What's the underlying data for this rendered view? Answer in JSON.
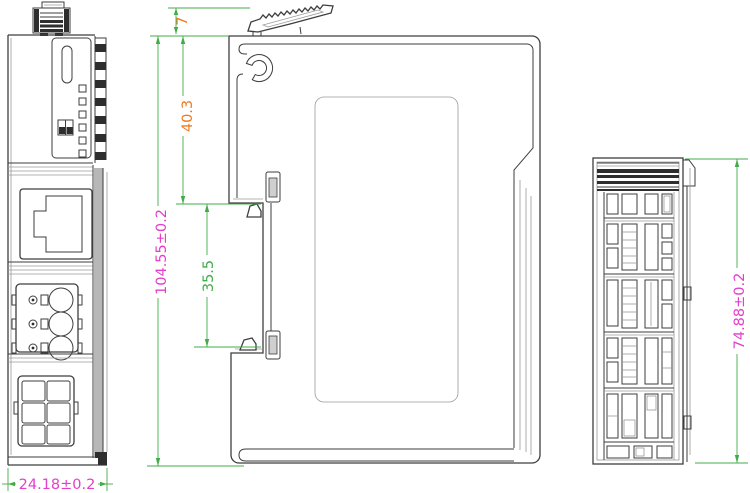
{
  "drawing": {
    "dimension_labels": {
      "clip_protrusion_height": "7",
      "upper_section_height": "40.3",
      "overall_height": "104.55±0.2",
      "din_slot_height": "35.5",
      "overall_width": "24.18±0.2",
      "overall_depth": "74.88±0.2"
    },
    "colors": {
      "dimension_line_green": "#42ac49",
      "dimension_text_orange": "#ef7a1e",
      "dimension_text_magenta": "#e33fca",
      "dimension_text_green": "#42ac49",
      "outline_dark": "#3e3e3e",
      "outline_light": "#9a9a9a"
    }
  }
}
